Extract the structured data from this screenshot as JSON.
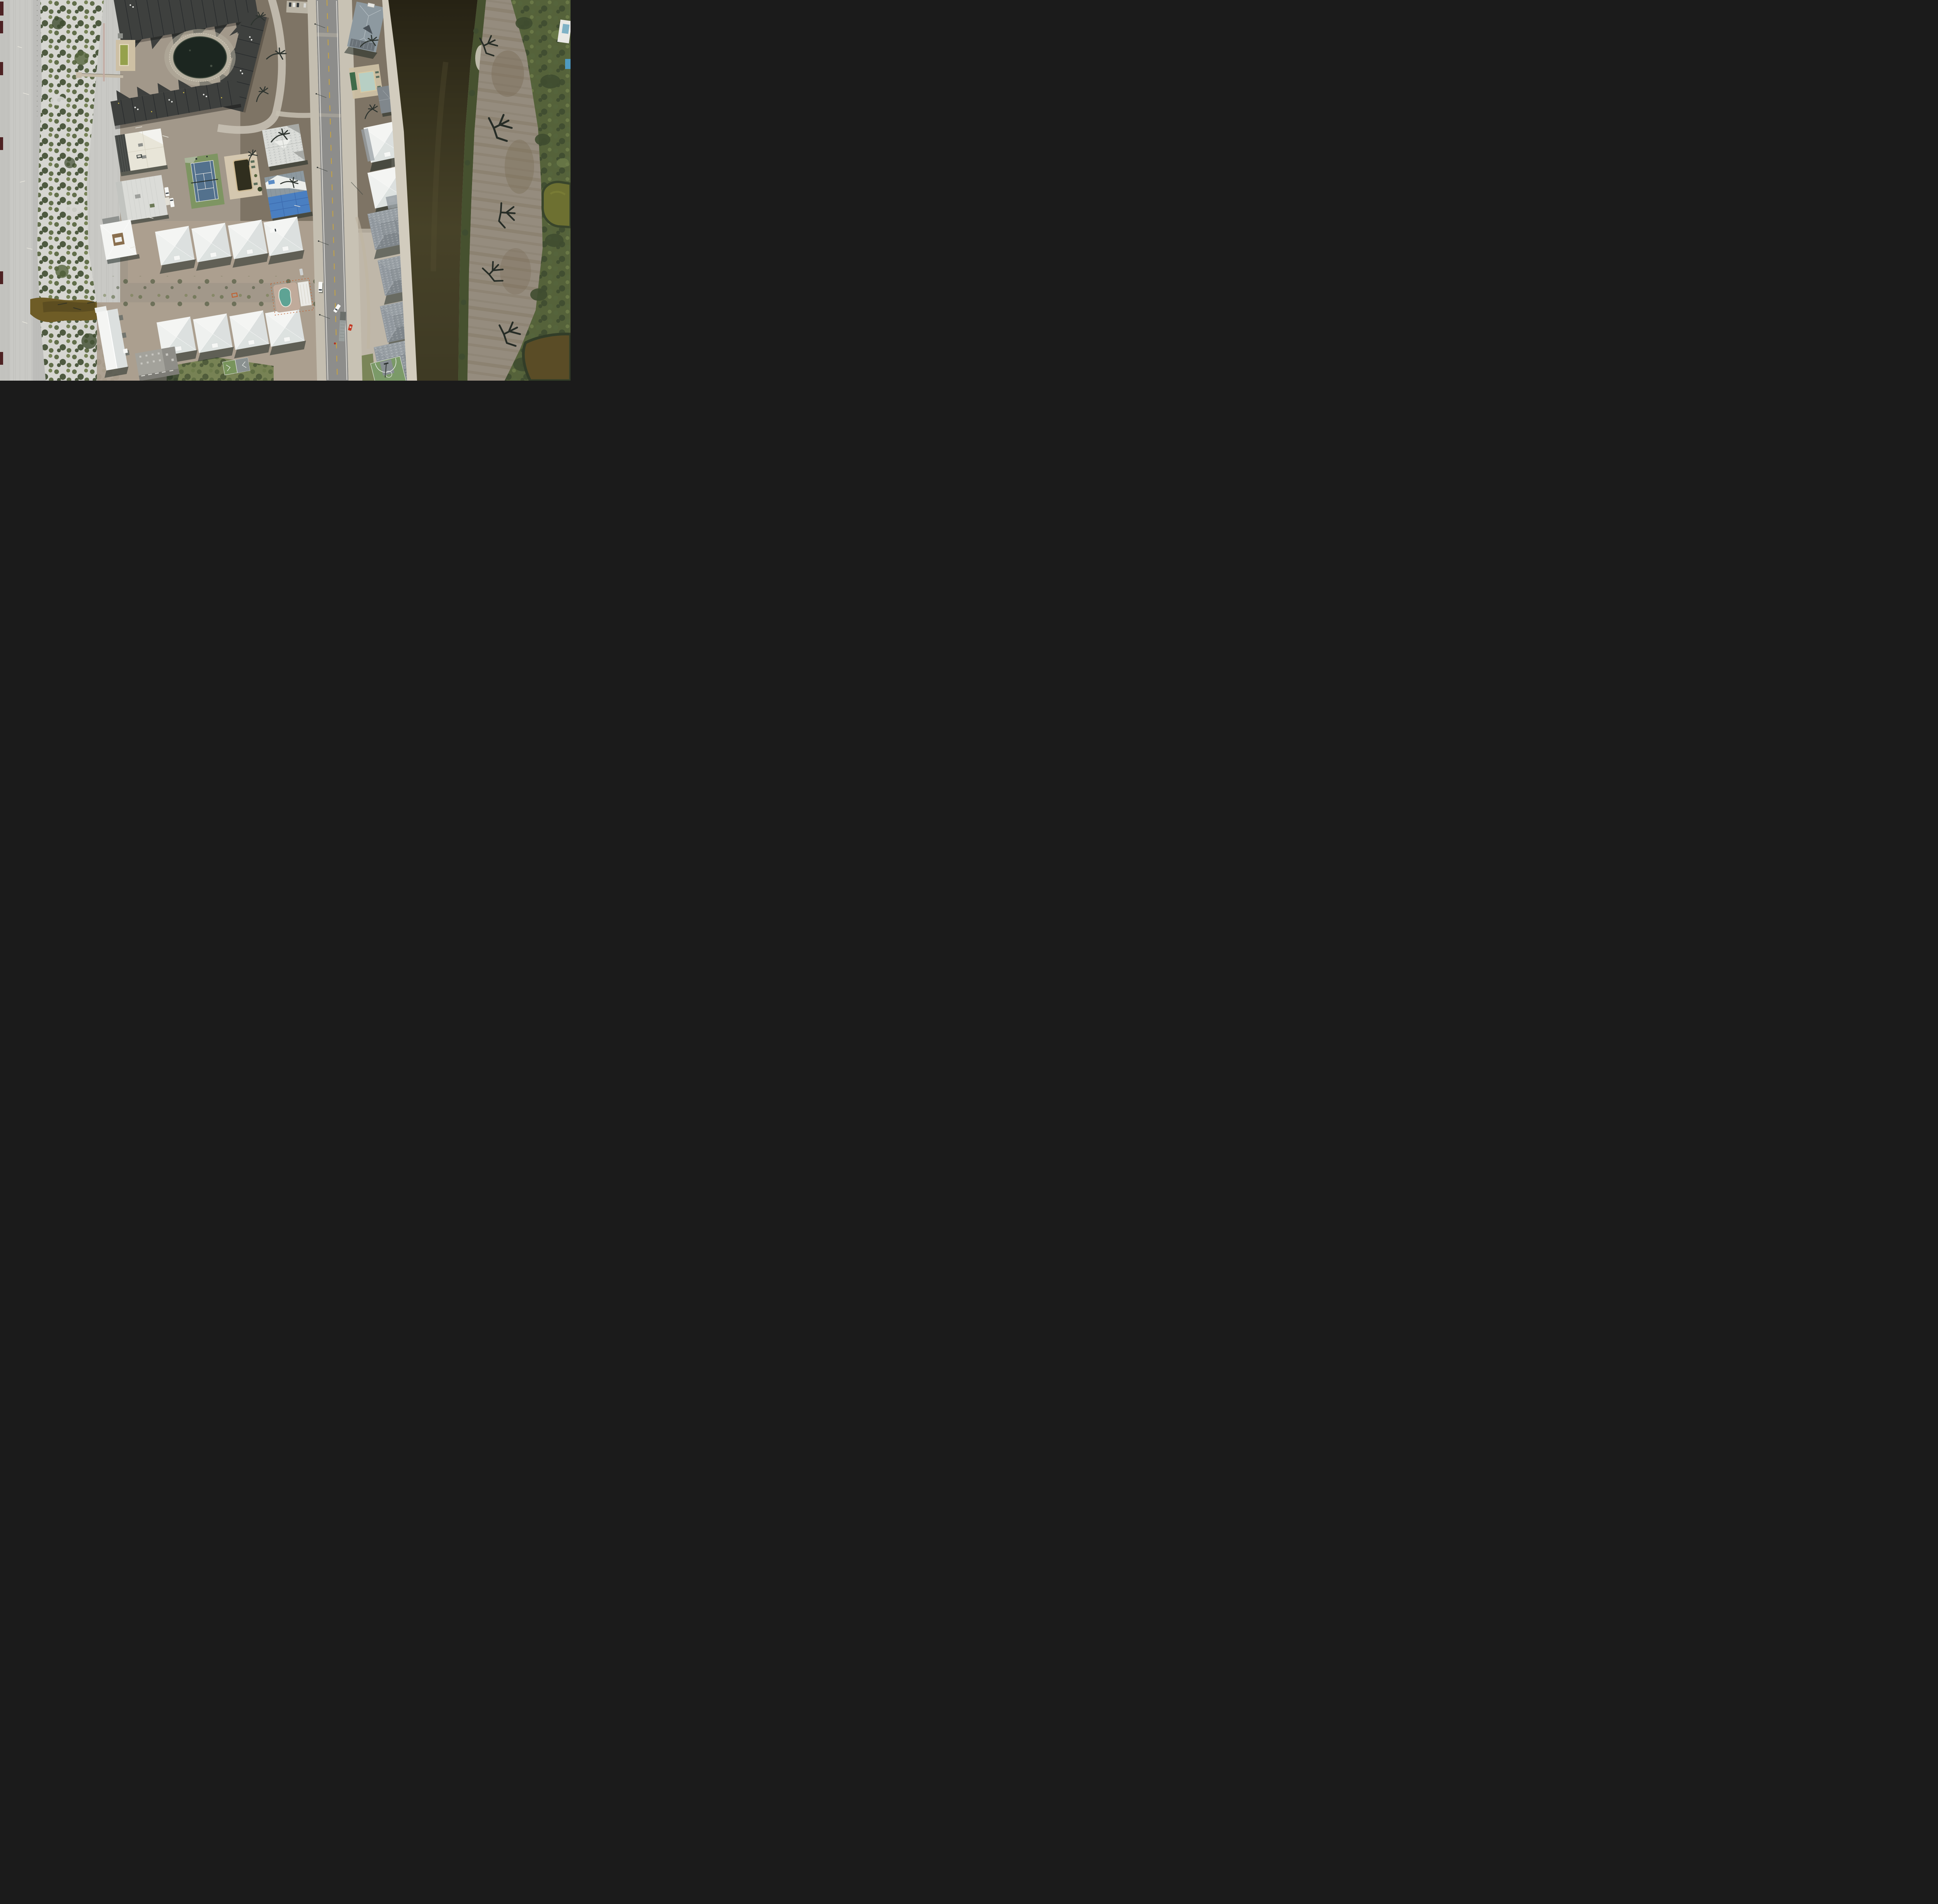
{
  "meta": {
    "title": "Nadir aerial photograph of a hurricane-damaged barrier-island neighborhood",
    "description": "Vertical aerial view: white sand beach and dune scrub on the left; a dark sawtooth-roof condominium complex with retention pond, algae-green pool, tennis court and murky community pool; rows of white hip-roofed cottages; a two-lane asphalt road running top to bottom; gray re-roofed houses along a dark olive canal; a storm-scoured dirt fairway, golf pond and green vegetation on the right."
  },
  "palette": {
    "beach_sand": "#c9c9c5",
    "beach_path": "#bbbbb7",
    "dune_sand": "#d6d6d1",
    "veg_dark": "#3f4c30",
    "veg_mid": "#55643c",
    "veg_light": "#6c7a48",
    "mud_brown": "#6e5c26",
    "ground_tan": "#a2988a",
    "ground_brown": "#7e7465",
    "ground_pink": "#ac9f8f",
    "paver_tan": "#c6bcaa",
    "asphalt": "#8d8d8b",
    "shoulder": "#c4beb0",
    "road_yellow": "#c9a43e",
    "line_white": "#eceae4",
    "condo_roof": "#3e403e",
    "condo_dark": "#26292b",
    "pond_dark": "#1c2620",
    "pond_ring": "#b7b0a0",
    "algae_pool": "#95a14c",
    "pool_deck": "#cec0a4",
    "murk_pool": "#302e1e",
    "tennis_apron": "#7e9562",
    "tennis_court": "#53718d",
    "roof_white": "#f4f5f3",
    "roof_white_shade": "#dce0df",
    "roof_cream": "#e8e5d8",
    "roof_gray": "#99a0a5",
    "roof_gray_dark": "#80878c",
    "roof_blue_gray": "#8d99a0",
    "tarp_blue": "#4a7fc1",
    "bank_sand": "#d2ccbe",
    "marsh_green": "#46512f",
    "field_gray": "#958c7e",
    "field_brown": "#7a6d58",
    "lawn_green": "#6d7d4a",
    "pond_olive": "#6d7031",
    "pond_brown": "#5a4c26",
    "red_car": "#c23a24",
    "orange_marker": "#c35f2d",
    "truck_white": "#f7f8f6",
    "artifact_red": "#3d0b0e",
    "court_green": "#7b9a68",
    "court_gray": "#878e91",
    "canal_top": "#262214",
    "canal_mid": "#474228",
    "canal_low": "#3e3a24"
  },
  "scene": {
    "regions": [
      {
        "id": "beach",
        "label": "white sand beach with vehicle tracks"
      },
      {
        "id": "dune-scrub",
        "label": "dune vegetation strip with sand blowouts"
      },
      {
        "id": "condo-complex",
        "label": "dark sawtooth-roof condominium complex"
      },
      {
        "id": "cottage-rows",
        "label": "two rows of white hip-roof cottages"
      },
      {
        "id": "road",
        "label": "two-lane asphalt road, yellow dashed centerline"
      },
      {
        "id": "canal",
        "label": "dark olive-brown tidal canal"
      },
      {
        "id": "scoured-field",
        "label": "storm-scoured dirt fairway with fallen trees"
      },
      {
        "id": "east-green",
        "label": "surviving green vegetation, golf pond, marsh"
      }
    ],
    "objects": {
      "condo_pond": "dark retention pond ringed with white rock",
      "condo_pool": "algae-green rectangular pool on tan deck",
      "tennis_court": "blue court on green apron, white lines, sagging net",
      "community_pool": "dark murky pool on tan paver deck",
      "white_hip_houses": 8,
      "courtyard_house": "white tarped roof with brown central atrium",
      "gable_building": "long white gable roof building",
      "patched_roof_house": "white-and-gray patched underlayment roof",
      "blue_tarp_house": "gray metal roof half covered by blue tarp",
      "gray_canal_houses": 6,
      "blue_gray_house_north": "large hip-roof house by canal, top of frame",
      "north_pool": "pale green pool with green awning",
      "kidney_pool": "turquoise kidney pool with orange safety fencing",
      "basketball_court": "green court, gray keys, white 3-point arcs",
      "shuffleboard_court": "small green court with white triangles",
      "concrete_building": "flat-roof gray concrete building, bottom left",
      "boardwalk": "beach access boardwalk over the dunes",
      "beach_channel": "muddy brown outwash channel through the dunes",
      "golf_pond": "olive-green pond at right edge",
      "marsh_pond": "brown marsh pond at bottom right corner"
    },
    "vehicles": [
      {
        "type": "white van",
        "location": "driving on road, lower middle"
      },
      {
        "type": "white pickup",
        "location": "north cottage lot"
      },
      {
        "type": "white pickup pair",
        "location": "west buildings parking"
      },
      {
        "type": "white pickup",
        "location": "east lot near road, bottom"
      },
      {
        "type": "red car",
        "location": "beside south gray house"
      },
      {
        "type": "long gray trailer",
        "location": "east shoulder, bottom"
      },
      {
        "type": "silver car",
        "location": "south cottage row"
      }
    ],
    "markings": {
      "road_centerline": "yellow dashed",
      "road_edges": "solid white",
      "left_edge_artifacts": 6
    }
  }
}
